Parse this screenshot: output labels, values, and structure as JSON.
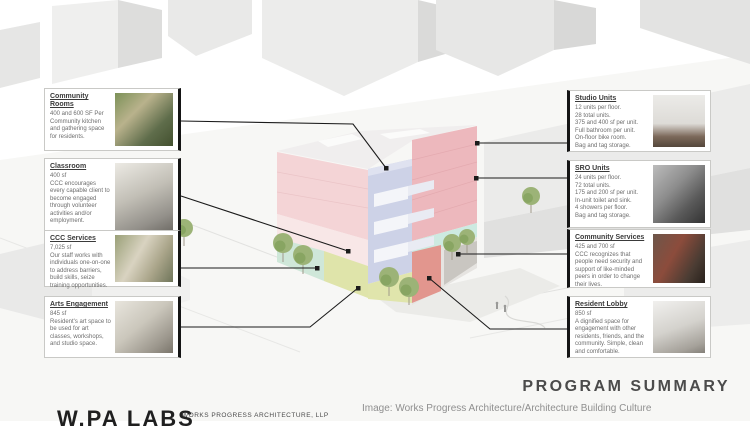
{
  "page": {
    "title": "PROGRAM SUMMARY",
    "image_credit": "Image: Works Progress Architecture/Architecture Building Culture",
    "logo_text": "W.PA LABS",
    "logo_subtext": "WORKS PROGRESS ARCHITECTURE, LLP"
  },
  "callouts": {
    "left": [
      {
        "title": "Community Rooms",
        "lines": [
          "400 and 600 SF Per",
          "Community kitchen and gathering space for residents."
        ],
        "photo": "community-room-interior-photo"
      },
      {
        "title": "Classroom",
        "lines": [
          "400 sf",
          "CCC encourages every capable client to become engaged through volunteer activities and/or employment."
        ],
        "photo": "classroom-interior-photo"
      },
      {
        "title": "CCC Services",
        "lines": [
          "7,025 sf",
          "Our staff works with individuals one-on-one to address barriers, build skills, seize training opportunities."
        ],
        "photo": "services-office-photo"
      },
      {
        "title": "Arts Engagement",
        "lines": [
          "845 sf",
          "Resident's art space to be used for art classes, workshops, and studio space."
        ],
        "photo": "art-studio-photo"
      }
    ],
    "right": [
      {
        "title": "Studio Units",
        "lines": [
          "12 units per floor.",
          "28 total units.",
          "375 and 400 sf per unit.",
          "Full bathroom per unit.",
          "On-floor bike room.",
          "Bag and tag storage."
        ],
        "photo": "studio-unit-interior-photo"
      },
      {
        "title": "SRO Units",
        "lines": [
          "24 units per floor.",
          "72 total units.",
          "175 and 200 sf per unit.",
          "In-unit toilet and sink.",
          "4 showers per floor.",
          "Bag and tag storage."
        ],
        "photo": "sro-unit-resident-photo"
      },
      {
        "title": "Community Services",
        "lines": [
          "425 and 700 sf",
          "CCC recognizes that people need security and support of like-minded peers in order to change their lives."
        ],
        "photo": "community-group-photo"
      },
      {
        "title": "Resident Lobby",
        "lines": [
          "850 sf",
          "A dignified space for engagement with other residents, friends, and the community. Simple, clean and comfortable."
        ],
        "photo": "lobby-interior-photo"
      }
    ]
  },
  "colors": {
    "callout_accent": "#151515",
    "facade_pink": "#edb8bd",
    "facade_pink_light": "#f4d4d6",
    "facade_periwinkle": "#cdd2e7",
    "facade_mint": "#cfe7d9",
    "facade_yellow_green": "#dfe4aa",
    "facade_salmon": "#e2968e",
    "context_gray": "#ececeb",
    "tree_green": "#9cb377"
  }
}
